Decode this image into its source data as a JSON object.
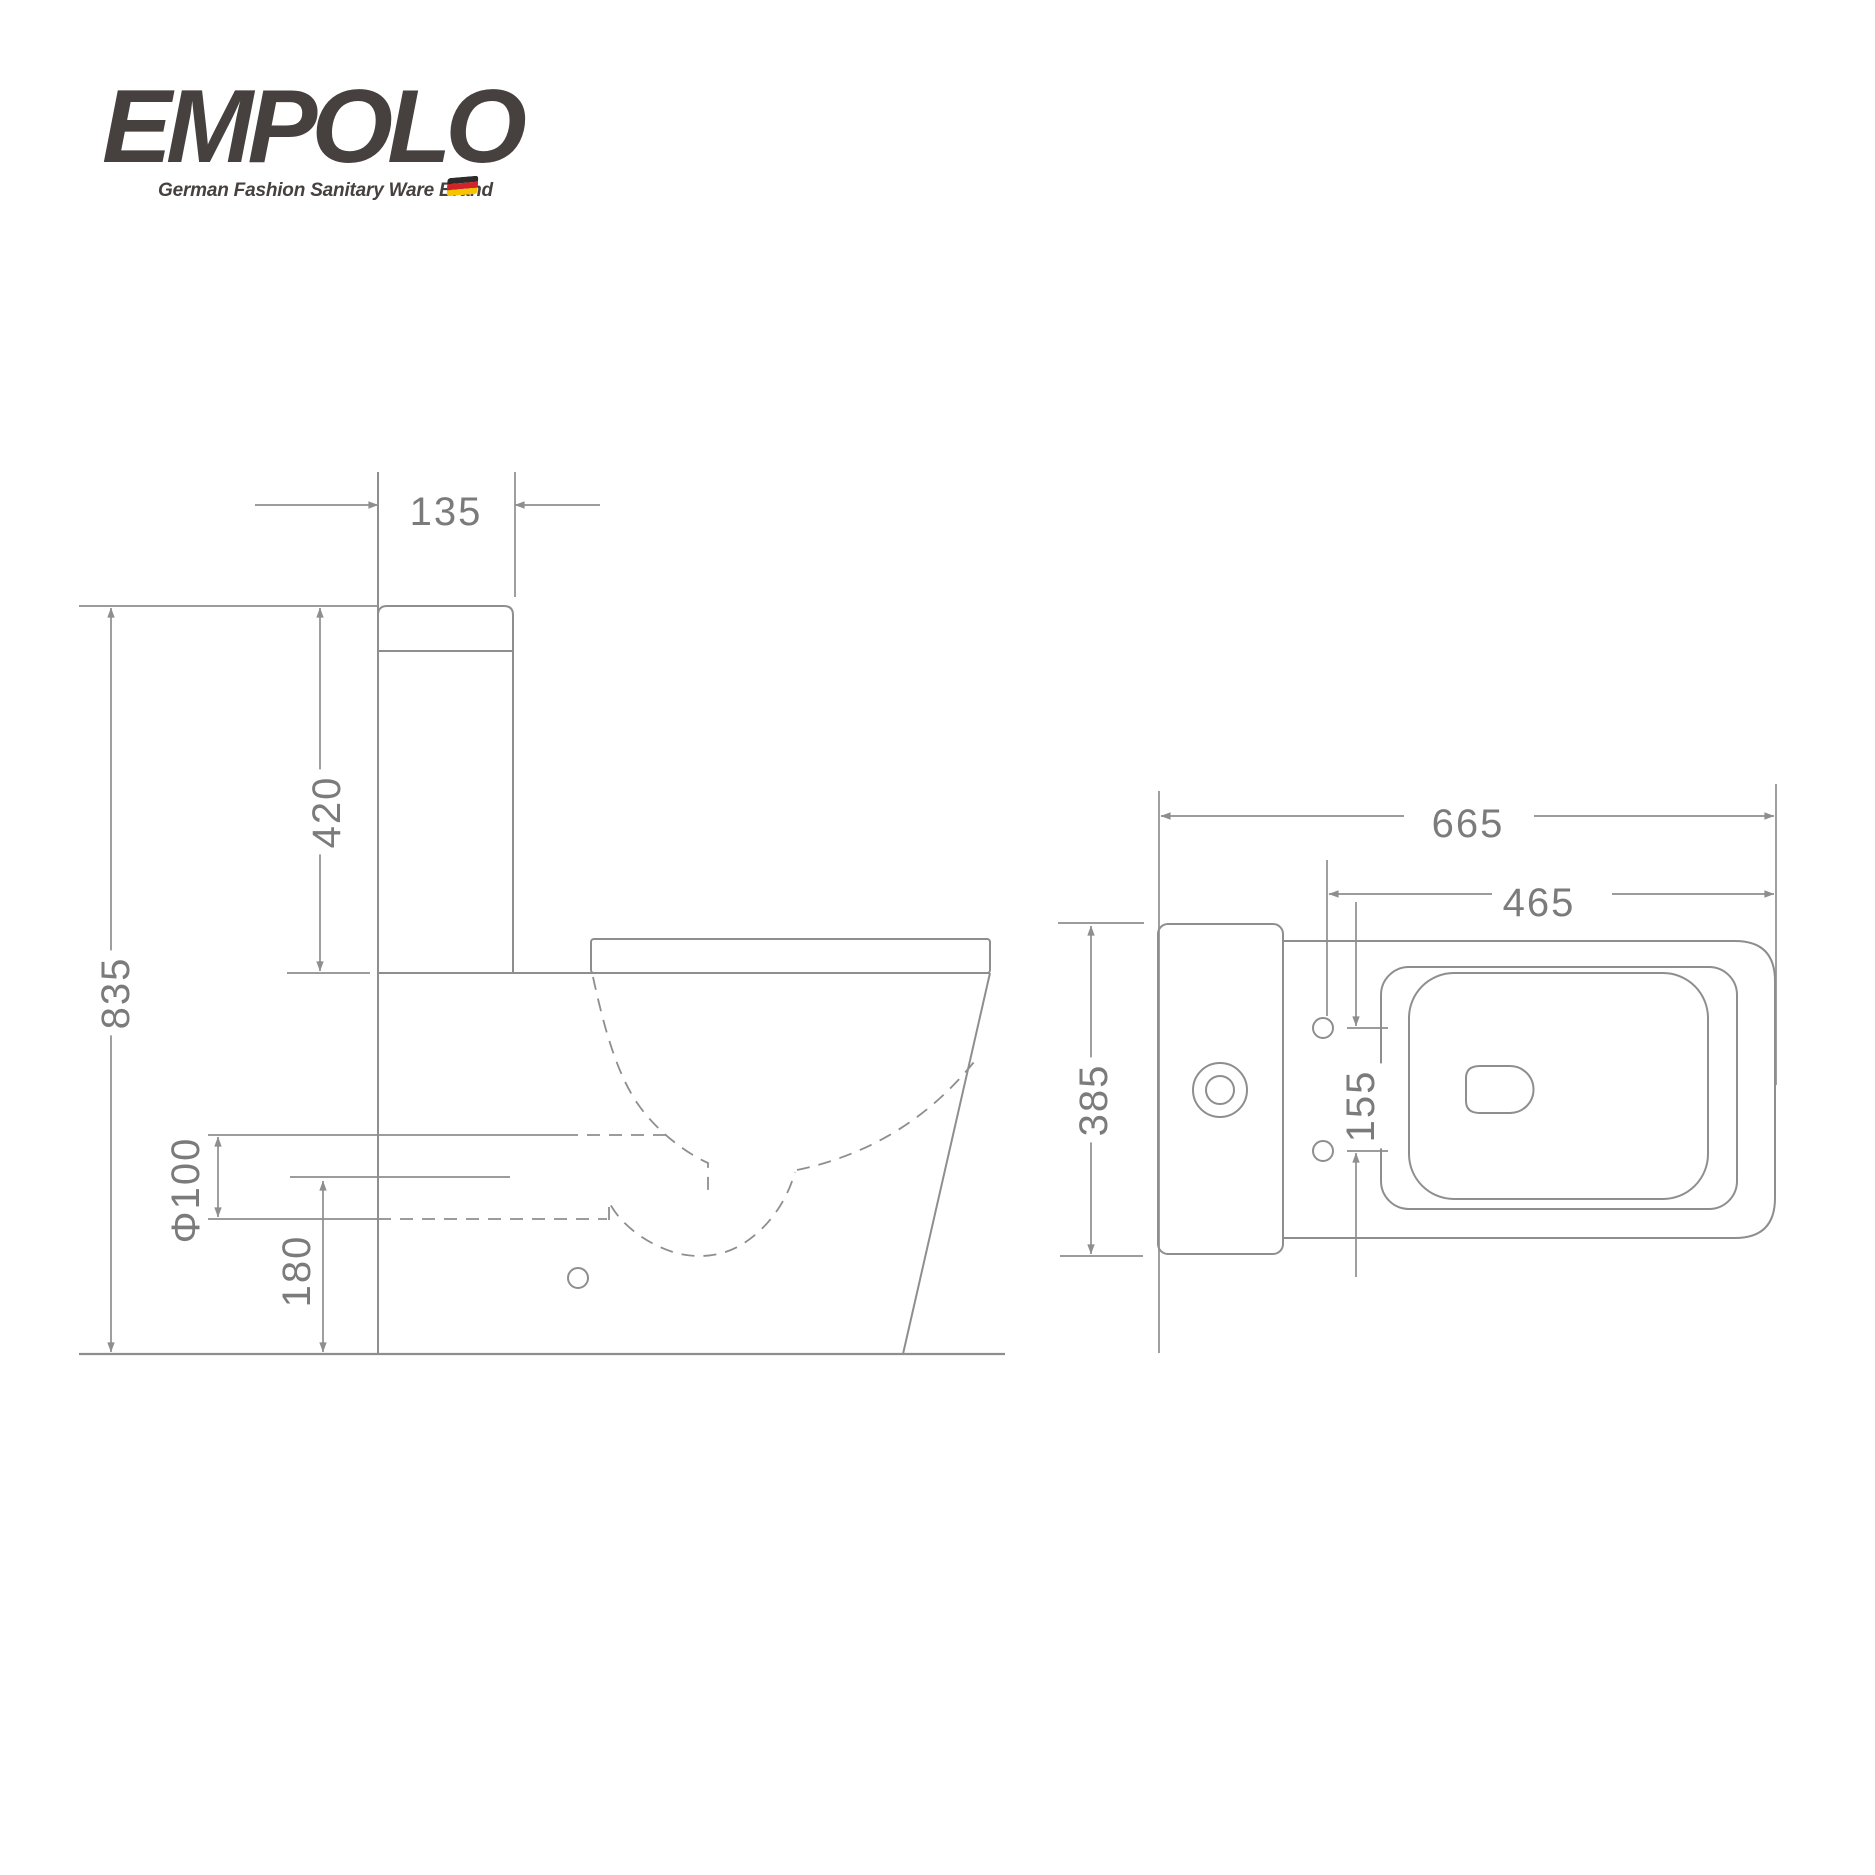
{
  "logo": {
    "brand": "EMPOLO",
    "tagline": "German Fashion Sanitary Ware Brand",
    "flag_icon": "german-flag",
    "brand_color": "#46403f",
    "flag_colors": [
      "#2d2a2a",
      "#d2232a",
      "#f7c500"
    ]
  },
  "drawing": {
    "line_color": "#8e8e8e",
    "text_color": "#7b7b7b",
    "side_view": {
      "tank_width": "135",
      "tank_height": "420",
      "total_height": "835",
      "drain_diameter": "Φ100",
      "drain_center_height": "180"
    },
    "top_view": {
      "total_depth": "665",
      "seat_depth": "465",
      "total_width": "385",
      "bolt_hole_spacing": "155"
    }
  }
}
